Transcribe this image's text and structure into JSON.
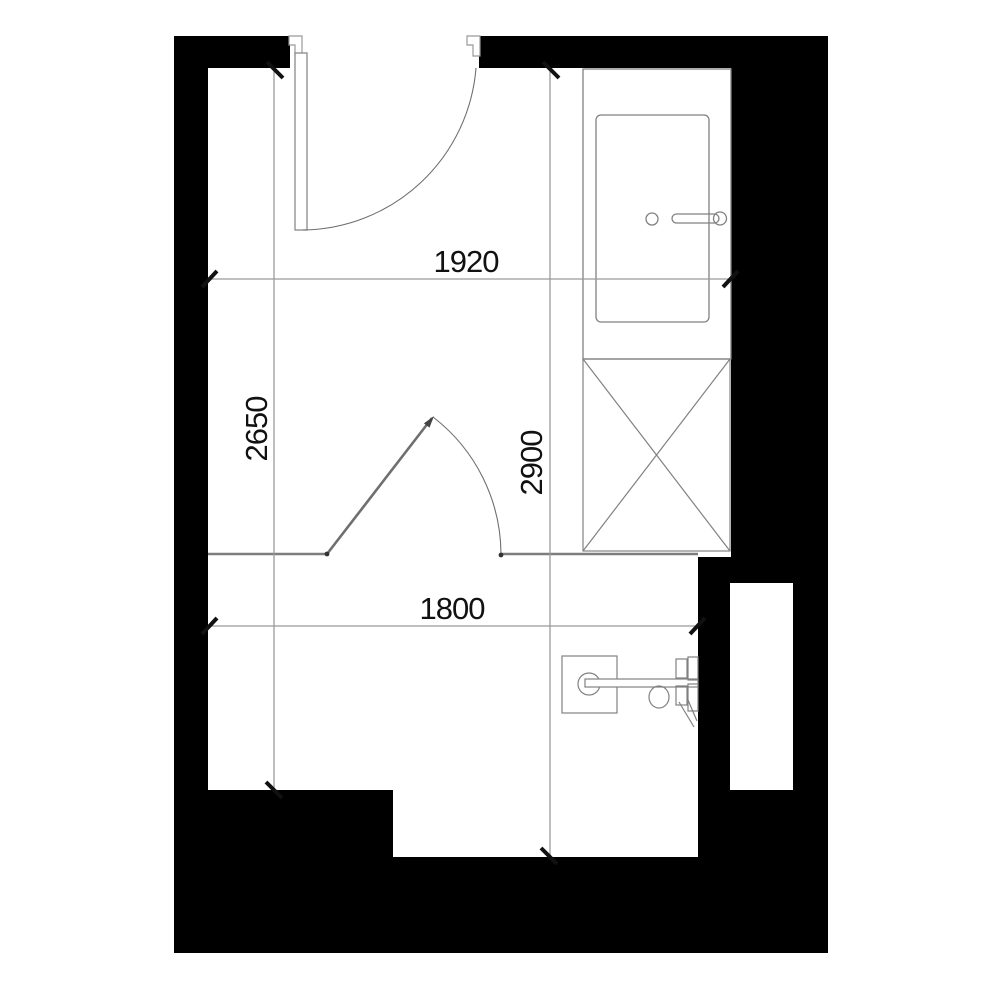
{
  "plan": {
    "title": "bathroom-floor-plan",
    "dimensions": {
      "top_width": "1920",
      "left_height": "2650",
      "inner_height": "2900",
      "bottom_width": "1800"
    },
    "fixtures": [
      "bathtub",
      "washing-machine",
      "wall-hung-toilet",
      "swing-door-top",
      "swing-door-middle",
      "wall-niche"
    ],
    "colors": {
      "wall": "#000000",
      "fixture_line": "#818181",
      "dimension_line": "#9a9a9a",
      "partition_line": "#7d7d7d",
      "tick": "#111111",
      "text": "#111111",
      "background": "#ffffff"
    }
  }
}
